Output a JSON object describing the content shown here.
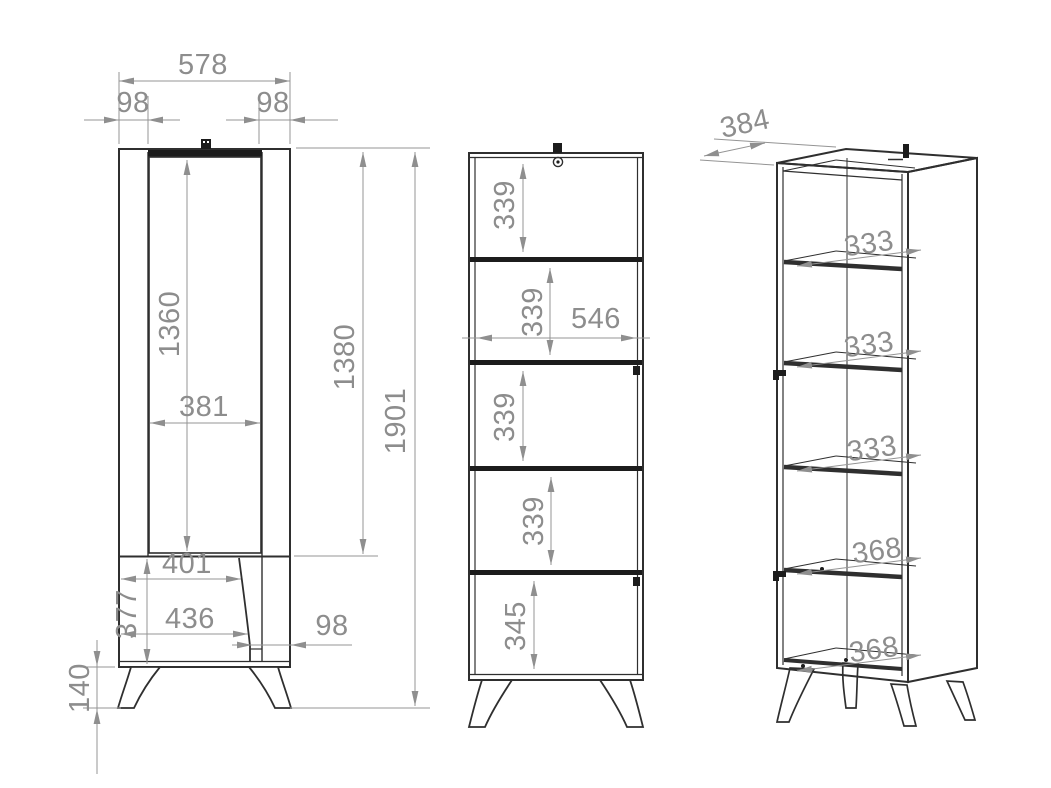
{
  "drawing_type": "furniture cabinet technical drawing, three views",
  "colors": {
    "line_ink": "#2f2f2f",
    "dimension_gray": "#8f8f8f",
    "background": "#ffffff"
  },
  "front_view": {
    "total_width": "578",
    "left_offset": "98",
    "right_offset": "98",
    "door_height": "1360",
    "door_width": "381",
    "upper_height": "1380",
    "total_height": "1901",
    "lower_inner_width": "401",
    "lower_height": "377",
    "lower_outer_width": "436",
    "lower_right_offset": "98",
    "leg_height": "140"
  },
  "section_view": {
    "gap_1": "339",
    "gap_2": "339",
    "inner_width": "546",
    "gap_3": "339",
    "gap_4": "339",
    "bottom_gap": "345"
  },
  "perspective_view": {
    "depth": "384",
    "shelf_gap_1": "333",
    "shelf_gap_2": "333",
    "shelf_gap_3": "333",
    "lower_gap_1": "368",
    "lower_gap_2": "368"
  }
}
